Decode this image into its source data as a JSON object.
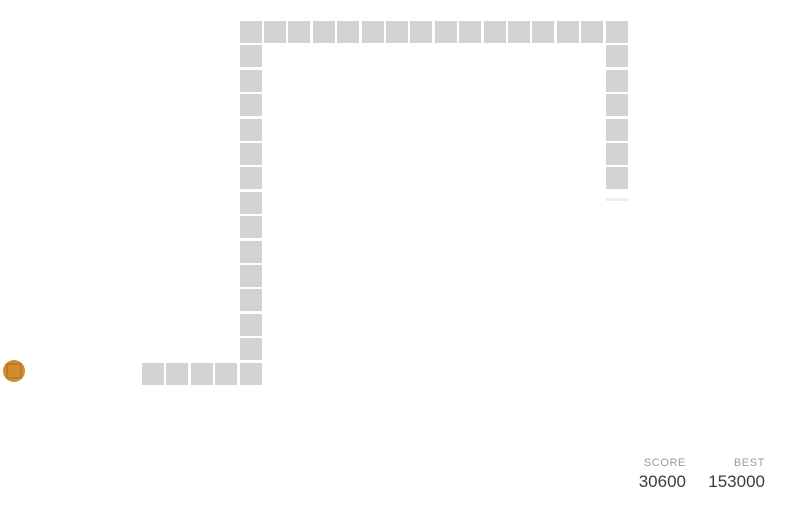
{
  "board": {
    "grid": {
      "origin_x": 142,
      "origin_y": 21,
      "pitch": 24.4,
      "cell_size": 22
    },
    "snake_color": "#d3d3d3",
    "snake_cells": [
      [
        0,
        14
      ],
      [
        1,
        14
      ],
      [
        2,
        14
      ],
      [
        3,
        14
      ],
      [
        4,
        14
      ],
      [
        4,
        13
      ],
      [
        4,
        12
      ],
      [
        4,
        11
      ],
      [
        4,
        10
      ],
      [
        4,
        9
      ],
      [
        4,
        8
      ],
      [
        4,
        7
      ],
      [
        4,
        6
      ],
      [
        4,
        5
      ],
      [
        4,
        4
      ],
      [
        4,
        3
      ],
      [
        4,
        2
      ],
      [
        4,
        1
      ],
      [
        4,
        0
      ],
      [
        5,
        0
      ],
      [
        6,
        0
      ],
      [
        7,
        0
      ],
      [
        8,
        0
      ],
      [
        9,
        0
      ],
      [
        10,
        0
      ],
      [
        11,
        0
      ],
      [
        12,
        0
      ],
      [
        13,
        0
      ],
      [
        14,
        0
      ],
      [
        15,
        0
      ],
      [
        16,
        0
      ],
      [
        17,
        0
      ],
      [
        18,
        0
      ],
      [
        19,
        0
      ],
      [
        19,
        1
      ],
      [
        19,
        2
      ],
      [
        19,
        3
      ],
      [
        19,
        4
      ],
      [
        19,
        5
      ],
      [
        19,
        6
      ]
    ],
    "partial_head_cell": {
      "x": 605.6,
      "y": 198,
      "width": 22,
      "height": 3,
      "color": "#ededed"
    },
    "food": {
      "x": 3,
      "y": 360,
      "size": 22,
      "color": "#d18c32",
      "inner_border_color": "#bd7d26"
    }
  },
  "scoreboard": {
    "score_label": "SCORE",
    "score_value": "30600",
    "best_label": "BEST",
    "best_value": "153000",
    "label_color": "#9b9b9b",
    "value_color": "#3c3c3c"
  }
}
